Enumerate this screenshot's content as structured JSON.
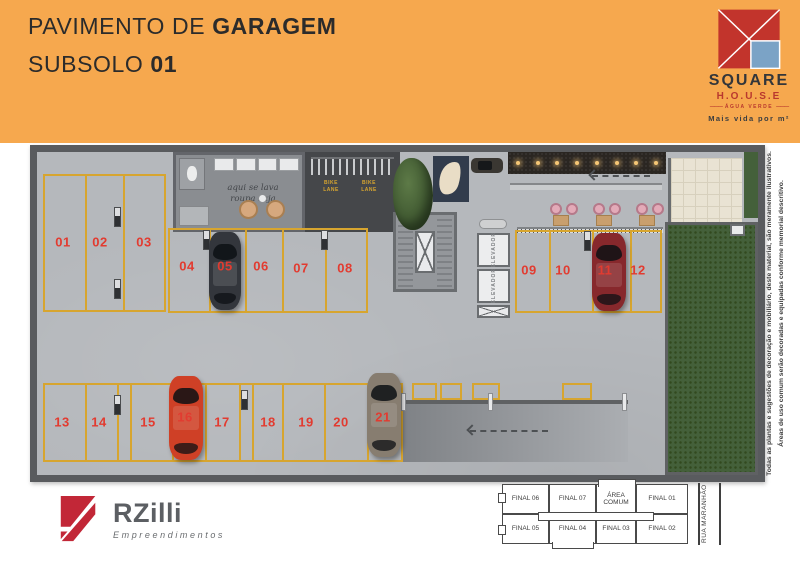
{
  "colors": {
    "header_bg": "#F6A84E",
    "accent_red": "#E23B30",
    "line_yellow": "#D7A52F",
    "wall": "#595B5E",
    "floor": "#B5B8BC",
    "garden_green": "#44603A",
    "brand_red": "#C2342C",
    "brand_blue": "#7BA3C6",
    "rzilli_red": "#C22737"
  },
  "header": {
    "title_line1": {
      "regular": "PAVIMENTO DE",
      "bold": "GARAGEM"
    },
    "title_line2": {
      "regular": "SUBSOLO",
      "bold": "01"
    }
  },
  "brand": {
    "name": "SQUARE",
    "house": "H.O.U.S.E",
    "location": "ÁGUA VERDE",
    "tagline": "Mais vida por m²"
  },
  "plan": {
    "spots": [
      "01",
      "02",
      "03",
      "04",
      "05",
      "06",
      "07",
      "08",
      "09",
      "10",
      "11",
      "12",
      "13",
      "14",
      "15",
      "16",
      "17",
      "18",
      "19",
      "20",
      "21"
    ],
    "laundry_note_line1": "aqui se lava",
    "laundry_note_line2": "roupa suja",
    "bike_lane_label": "BIKE\nLANE",
    "elevator_label": "ELEVADOR"
  },
  "developer": {
    "name": "RZilli",
    "subtitle": "Empreendimentos"
  },
  "keyplan": {
    "row1": [
      "FINAL 06",
      "FINAL 07",
      "ÁREA COMUM",
      "FINAL 01"
    ],
    "row2": [
      "FINAL 05",
      "FINAL 04",
      "FINAL 03",
      "FINAL 02"
    ],
    "street": "RUA MARANHÃO"
  },
  "disclaimer": {
    "line1": "Todas as plantas e sugestões de decoração e mobiliário, deste material, são meramente ilustrativos.",
    "line2": "Áreas de uso comum serão decoradas e equipadas conforme memorial descritivo."
  }
}
